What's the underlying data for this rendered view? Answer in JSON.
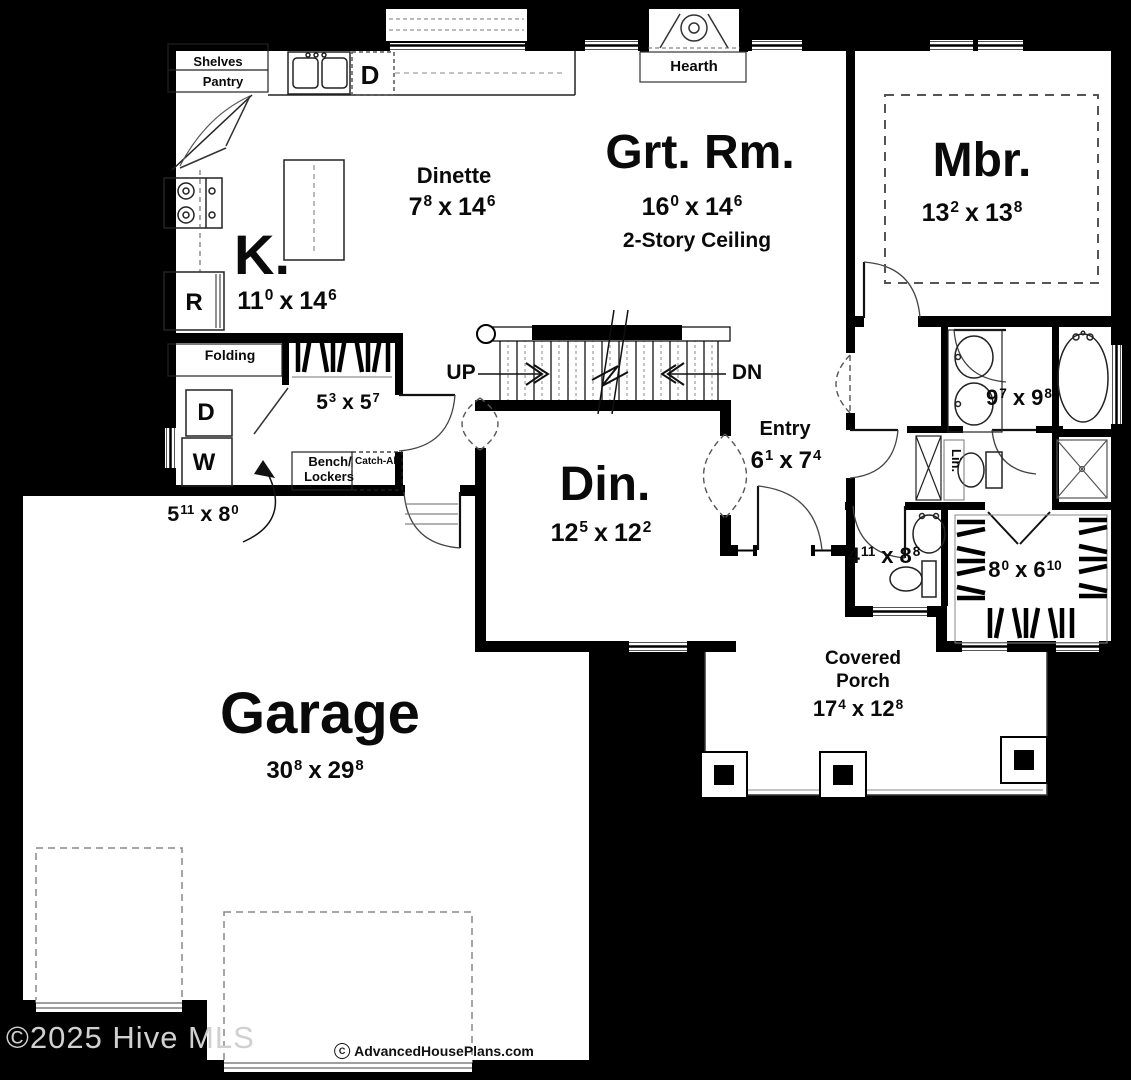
{
  "plan": {
    "watermark": "©2025 Hive MLS",
    "credit": {
      "symbol": "C",
      "text": "AdvancedHousePlans.com"
    },
    "sep": "x",
    "labels": {
      "shelves": "Shelves",
      "pantry": "Pantry",
      "hearth": "Hearth",
      "dishwasher": "D",
      "refrigerator": "R",
      "dryer": "D",
      "washer": "W",
      "folding": "Folding",
      "bench": "Bench/",
      "lockers": "Lockers",
      "catch_all": "Catch-All",
      "linen": "Lin.",
      "up": "UP",
      "down": "DN"
    },
    "rooms": {
      "kitchen": {
        "name": "K.",
        "dim": {
          "ft1": "11",
          "in1": "0",
          "ft2": "14",
          "in2": "6"
        }
      },
      "dinette": {
        "name": "Dinette",
        "dim": {
          "ft1": "7",
          "in1": "8",
          "ft2": "14",
          "in2": "6"
        }
      },
      "great_room": {
        "name": "Grt. Rm.",
        "note": "2-Story Ceiling",
        "dim": {
          "ft1": "16",
          "in1": "0",
          "ft2": "14",
          "in2": "6"
        }
      },
      "master_bedroom": {
        "name": "Mbr.",
        "dim": {
          "ft1": "13",
          "in1": "2",
          "ft2": "13",
          "in2": "8"
        }
      },
      "dining": {
        "name": "Din.",
        "dim": {
          "ft1": "12",
          "in1": "5",
          "ft2": "12",
          "in2": "2"
        }
      },
      "entry": {
        "name": "Entry",
        "dim": {
          "ft1": "6",
          "in1": "1",
          "ft2": "7",
          "in2": "4"
        }
      },
      "laundry": {
        "dim": {
          "ft1": "5",
          "in1": "11",
          "ft2": "8",
          "in2": "0"
        }
      },
      "mudroom": {
        "dim": {
          "ft1": "5",
          "in1": "3",
          "ft2": "5",
          "in2": "7"
        }
      },
      "master_bath": {
        "dim": {
          "ft1": "9",
          "in1": "7",
          "ft2": "9",
          "in2": "8"
        }
      },
      "powder": {
        "dim": {
          "ft1": "4",
          "in1": "11",
          "ft2": "8",
          "in2": "8"
        }
      },
      "closet": {
        "dim": {
          "ft1": "8",
          "in1": "0",
          "ft2": "6",
          "in2": "10"
        }
      },
      "garage": {
        "name": "Garage",
        "dim": {
          "ft1": "30",
          "in1": "8",
          "ft2": "29",
          "in2": "8"
        }
      },
      "porch": {
        "name1": "Covered",
        "name2": "Porch",
        "dim": {
          "ft1": "17",
          "in1": "4",
          "ft2": "12",
          "in2": "8"
        }
      }
    },
    "colors": {
      "background": "#000000",
      "floor": "#ffffff",
      "ink": "#0a0a0a",
      "watermark": "#d0d0d0"
    }
  }
}
